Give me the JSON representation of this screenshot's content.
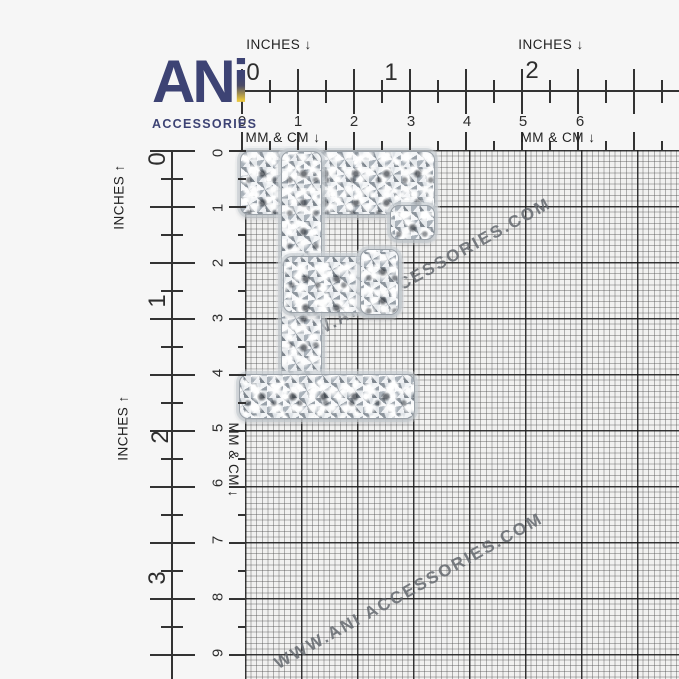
{
  "brand": {
    "logo": "AN",
    "logo_accent": "i",
    "subtitle": "ACCESSORIES",
    "navy": "#3d4374",
    "gold": "#e8c63e"
  },
  "rulers": {
    "top": {
      "inches_label_left": "INCHES ↓",
      "inches_label_right": "INCHES ↓",
      "mmcm_label_left": "MM & CM ↓",
      "mmcm_label_right": "MM & CM ↓",
      "inch_numbers": [
        "0",
        "1",
        "2"
      ],
      "cm_numbers": [
        "0",
        "1",
        "2",
        "3",
        "4",
        "5",
        "6"
      ]
    },
    "left": {
      "inches_label_upper": "INCHES ↑",
      "inches_label_lower": "INCHES ↑",
      "mmcm_label": "MM & CM ↓",
      "inch_numbers": [
        "0",
        "1",
        "2",
        "3"
      ],
      "cm_numbers": [
        "0",
        "1",
        "2",
        "3",
        "4",
        "5",
        "6",
        "7",
        "8",
        "9"
      ]
    }
  },
  "watermark": {
    "text": "WWW.ANI ACCESSORIES.COM",
    "color": "#7d8288"
  },
  "product": {
    "letter": "F",
    "description": "silver rhinestone letter F applique on measurement grid"
  }
}
